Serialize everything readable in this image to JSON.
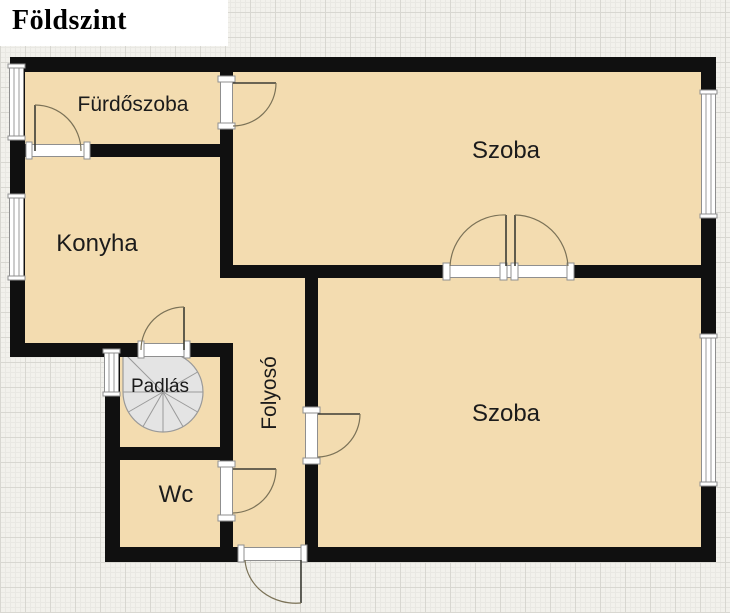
{
  "title": "Földszint",
  "rooms": [
    {
      "name": "furdoszoba",
      "label": "Fürdőszoba"
    },
    {
      "name": "szoba-felso",
      "label": "Szoba"
    },
    {
      "name": "konyha",
      "label": "Konyha"
    },
    {
      "name": "padlas",
      "label": "Padlás"
    },
    {
      "name": "folyoso",
      "label": "Folyosó"
    },
    {
      "name": "wc",
      "label": "Wc"
    },
    {
      "name": "szoba-also",
      "label": "Szoba"
    }
  ],
  "colors": {
    "room_fill": "#f3dcb0",
    "wall": "#101010",
    "grid_bg": "#f2f1ec",
    "grid_major": "#d8d7d1",
    "grid_minor": "#e9e8e3",
    "stair_fill": "#e4e4e4",
    "stair_line": "#9a9a9a",
    "door_arc": "#7b7257",
    "door_leaf": "#3c3c34",
    "opening_stroke": "#8f8f8f",
    "label_color": "#1b1b1b",
    "title_color": "#000000"
  }
}
